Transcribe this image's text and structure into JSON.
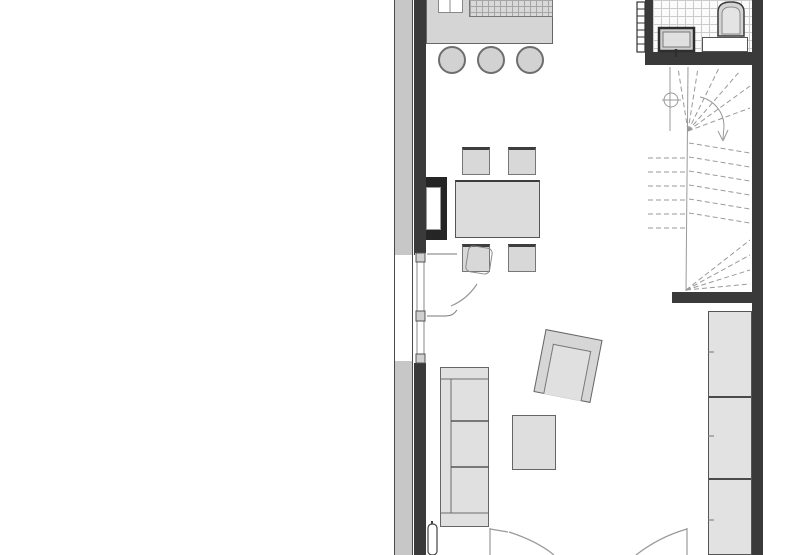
{
  "document": {
    "type": "architectural floor plan",
    "view": "ground floor, cropped top and bottom",
    "label": "Floor plan"
  },
  "colors": {
    "background": "#ffffff",
    "wall": "#3a3a3a",
    "outer_wall_band": "#c7c7c7",
    "furniture_fill": "#e0e0e0",
    "furniture_fill_dark": "#d2d2d2",
    "outline": "#666666",
    "thin_line": "#999999",
    "tile_line": "#cccccc"
  },
  "rooms": {
    "kitchen": {
      "label": "Kitchen area",
      "items": [
        "counter",
        "double-sink",
        "tiled-worktop",
        "bar-stool",
        "bar-stool",
        "bar-stool"
      ],
      "stool_count": 3
    },
    "dining": {
      "label": "Dining area",
      "items": [
        "dining-table",
        "chair",
        "chair",
        "chair",
        "chair",
        "wall-fireplace"
      ],
      "chair_count": 4
    },
    "living": {
      "label": "Living area",
      "items": [
        "three-seat-sofa",
        "coffee-table",
        "armchair"
      ],
      "sofa_cushions": 3
    },
    "bathroom": {
      "label": "Bathroom",
      "items": [
        "toilet",
        "washbasin",
        "segmented-radiator",
        "shelf",
        "tiled-floor"
      ]
    },
    "stairs": {
      "label": "Winder staircase",
      "items": [
        "fanned-treads",
        "newel-circle-symbol",
        "walking-line-arc-with-arrow"
      ]
    },
    "storage": {
      "label": "Built-in wardrobe",
      "sections": 3
    }
  },
  "openings": {
    "terrace_door": "glazed door in left wall with quarter-circle swing arc",
    "window": "glazed window section in left wall below door",
    "entry_doors": "two opposing door swings at bottom edge (cut off)"
  }
}
